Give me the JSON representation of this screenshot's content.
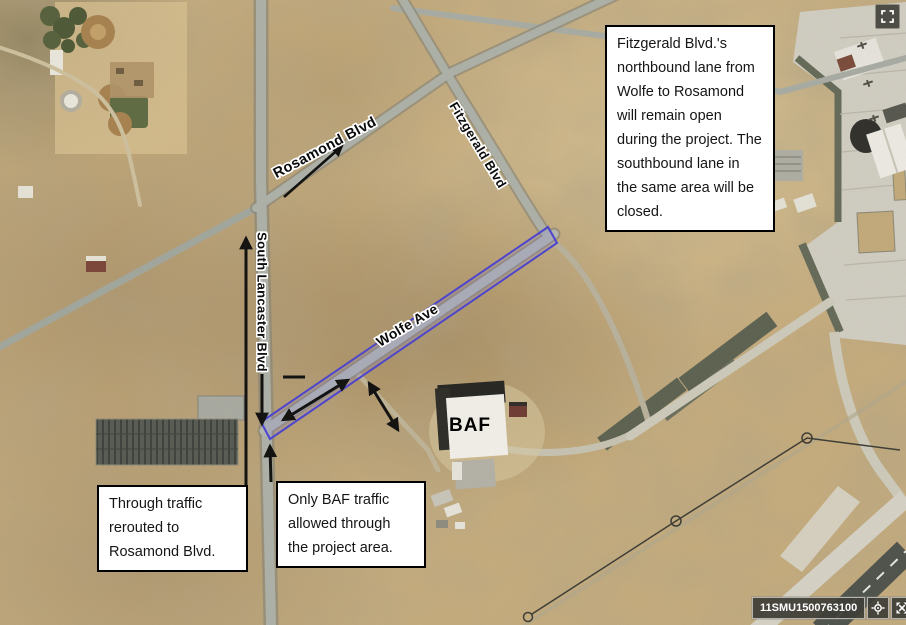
{
  "road_labels": {
    "rosamond": "Rosamond Blvd",
    "fitzgerald": "Fitzgerald Blvd",
    "lancaster": "South Lancaster Blvd",
    "wolfe": "Wolfe Ave"
  },
  "building_labels": {
    "baf": "BAF"
  },
  "callouts": {
    "fitzgerald_lanes": "Fitzgerald Blvd.'s northbound lane from Wolfe to Rosamond will remain open during the project.  The southbound lane in the same area will be closed.",
    "through_traffic": "Through traffic rerouted to Rosamond Blvd.",
    "baf_traffic": "Only BAF traffic allowed through the project area."
  },
  "statusbar": {
    "coordinate": "11SMU1500763100",
    "icons": [
      "crosshair-locate-icon",
      "extent-arrows-icon",
      "chevron-up-icon"
    ]
  },
  "controls": {
    "fullscreen": "fullscreen-icon"
  },
  "colors": {
    "project_area_stroke": "#4a42d2",
    "project_area_fill": "rgba(130,125,235,0.18)",
    "annotation_arrow": "#0d0d0d",
    "callout_border": "#000000",
    "callout_bg": "#ffffff",
    "desert_base": "#c7ad7e",
    "road_gray": "#adb2aa",
    "runway_dark": "#4d524b"
  }
}
